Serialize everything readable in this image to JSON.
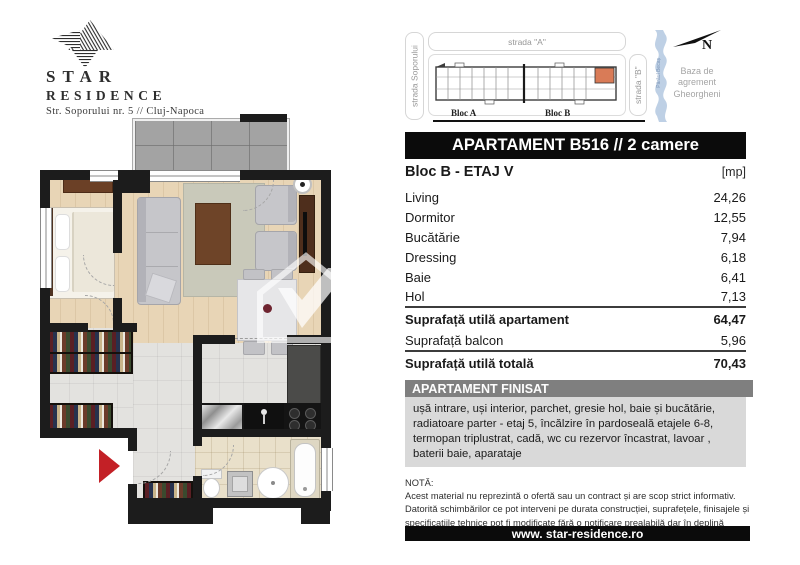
{
  "logo": {
    "line1": "STAR",
    "line2": "RESIDENCE",
    "address": "Str. Soporului nr. 5 // Cluj-Napoca"
  },
  "site_plan": {
    "street_left": "strada Soporului",
    "street_top": "strada \"A\"",
    "street_right": "strada \"B\"",
    "river": "Pârâul Becaș",
    "compass_n": "N",
    "area_label": "Baza de agrement Gheorgheni",
    "bloc_a": "Bloc A",
    "bloc_b": "Bloc B"
  },
  "apartment": {
    "title": "APARTAMENT B516 // 2 camere",
    "block_floor": "Bloc B - ETAJ V",
    "unit_header": "[mp]",
    "rooms": [
      {
        "label": "Living",
        "value": "24,26"
      },
      {
        "label": "Dormitor",
        "value": "12,55"
      },
      {
        "label": "Bucătărie",
        "value": "7,94"
      },
      {
        "label": "Dressing",
        "value": "6,18"
      },
      {
        "label": "Baie",
        "value": "6,41"
      },
      {
        "label": "Hol",
        "value": "7,13"
      }
    ],
    "summary": [
      {
        "label": "Suprafață utilă apartament",
        "value": "64,47"
      },
      {
        "label": "Suprafață balcon",
        "value": "5,96"
      },
      {
        "label": "Suprafață utilă totală",
        "value": "70,43"
      }
    ],
    "finished": {
      "title": "APARTAMENT FINISAT",
      "description": "ușă intrare, uși interior, parchet, gresie hol, baie și bucătărie, radiatoare parter - etaj 5, încălzire în pardoseală etajele 6-8, termopan triplustrat, cadă, wc cu rezervor încastrat, lavoar , baterii baie, aparataje"
    },
    "note": {
      "title": "NOTĂ:",
      "lines": [
        "Acest material nu reprezintă o ofertă sau un contract și are scop strict informativ.",
        "Datorită schimbărilor ce pot interveni pe durata construcției, suprafețele, finisajele și specificațiile tehnice pot fi modificate fără o notificare prealabilă dar în deplină concordanță cu orice contract semnat."
      ]
    },
    "website": "www. star-residence.ro"
  },
  "colors": {
    "wall": "#1c1c1c",
    "wood_floor": "#e8d5b6",
    "tile_floor": "#e3e2df",
    "bath_floor": "#e9e0ca",
    "entrance_arrow": "#c32026",
    "unit_highlight": "#d97b57",
    "river_blue": "#b3c8e0",
    "header_bar": "#0b0b0b",
    "finisat_header": "#7f7f7f",
    "finisat_body": "#d9d9d9"
  }
}
